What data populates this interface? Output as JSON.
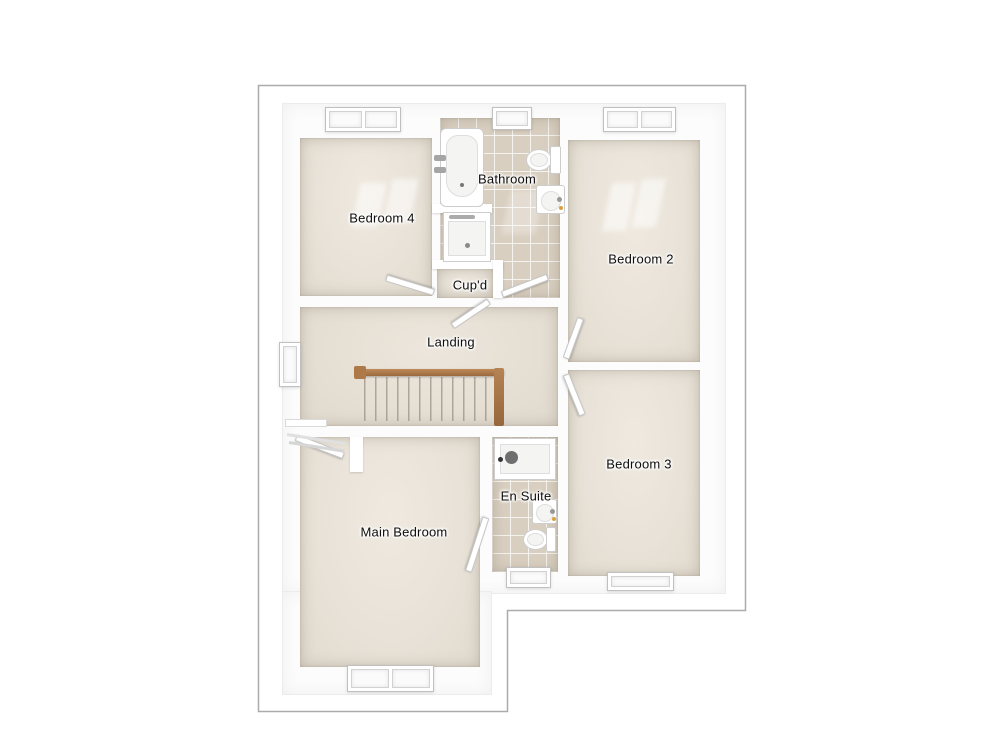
{
  "floorplan": {
    "type": "floor-plan",
    "rooms": [
      {
        "id": "bedroom-4",
        "label": "Bedroom 4",
        "floor": "carpet",
        "features": [
          "window"
        ]
      },
      {
        "id": "bathroom",
        "label": "Bathroom",
        "floor": "tile",
        "features": [
          "window",
          "bathtub",
          "shower",
          "toilet",
          "wash-basin",
          "door"
        ]
      },
      {
        "id": "bedroom-2",
        "label": "Bedroom 2",
        "floor": "carpet",
        "features": [
          "window",
          "door"
        ]
      },
      {
        "id": "cupboard",
        "label": "Cup'd",
        "floor": "carpet",
        "features": [
          "door"
        ]
      },
      {
        "id": "landing",
        "label": "Landing",
        "floor": "carpet",
        "features": [
          "window",
          "staircase",
          "handrail",
          "radiator"
        ]
      },
      {
        "id": "bedroom-3",
        "label": "Bedroom 3",
        "floor": "carpet",
        "features": [
          "window",
          "door"
        ]
      },
      {
        "id": "en-suite",
        "label": "En Suite",
        "floor": "tile",
        "features": [
          "window",
          "shower",
          "toilet",
          "wash-basin",
          "door"
        ]
      },
      {
        "id": "main-bedroom",
        "label": "Main Bedroom",
        "floor": "carpet",
        "features": [
          "double-window",
          "door",
          "wardrobe-nook"
        ]
      }
    ],
    "colors": {
      "background": "#ffffff",
      "outline": "#ababab",
      "wall": "#ffffff",
      "carpet": "#e8e2d8",
      "tile": "#d9cfc0",
      "handrail": "#ad7948"
    }
  }
}
